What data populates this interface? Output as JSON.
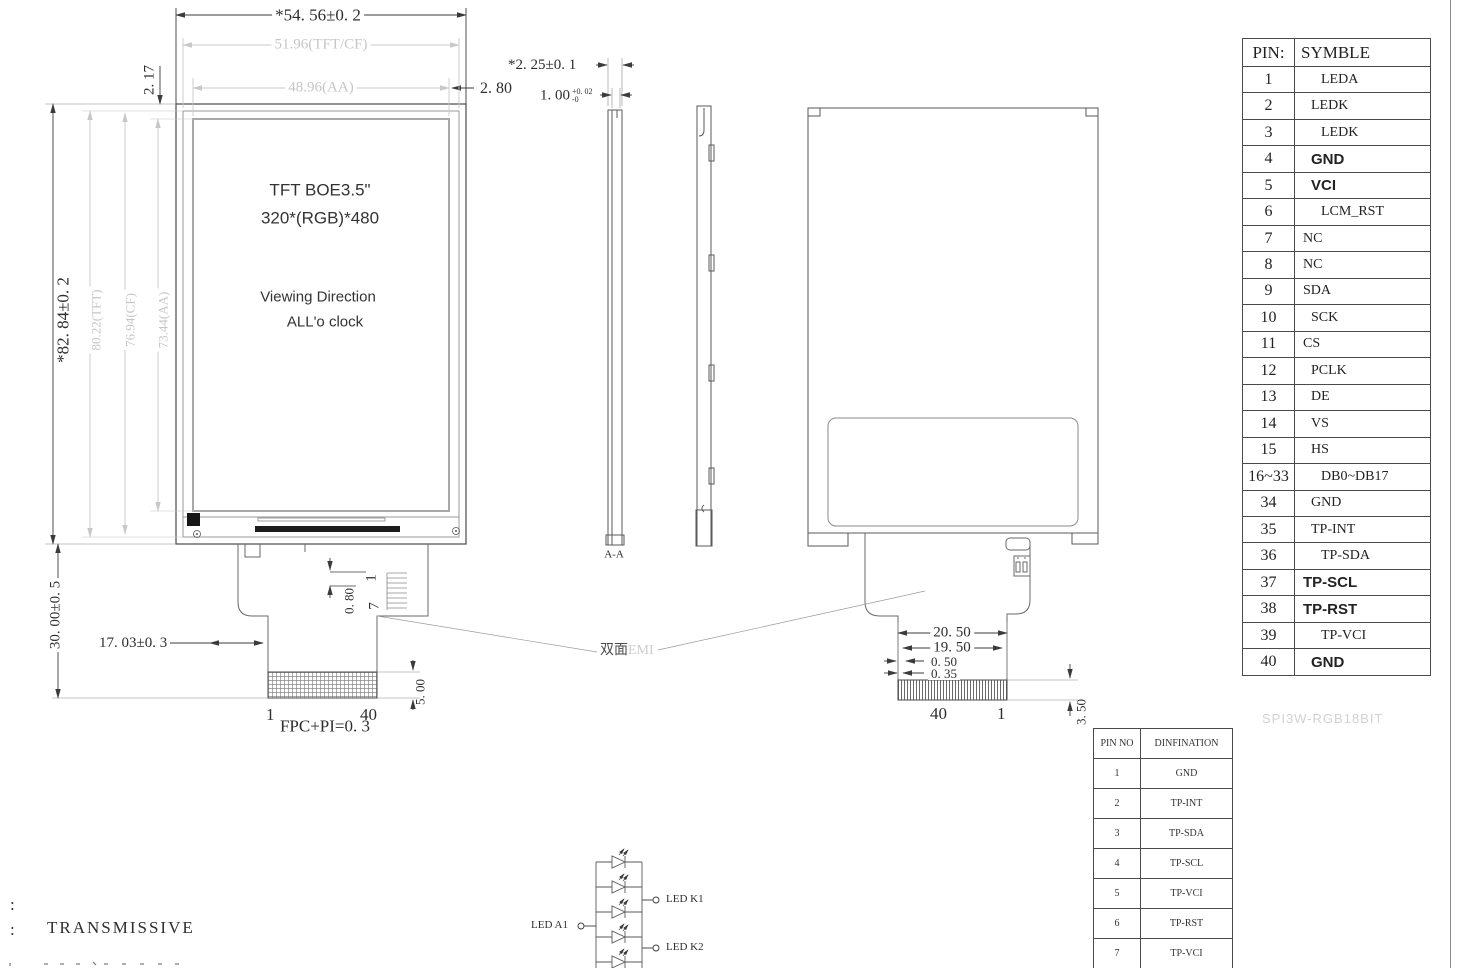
{
  "front_view": {
    "display_title": "TFT BOE3.5\"",
    "display_resolution": "320*(RGB)*480",
    "viewing_line1": "Viewing Direction",
    "viewing_line2": "ALL'o clock",
    "dims": {
      "width_total": "*54. 56±0. 2",
      "width_tft": "51.96(TFT/CF)",
      "width_aa": "48.96(AA)",
      "offset_right": "2. 80",
      "offset_top": "2. 17",
      "height_total": "*82. 84±0. 2",
      "height_tft": "80.22(TFT)",
      "height_cf": "76.94(CF)",
      "height_aa": "73.44(AA)",
      "fpc_length": "30. 00±0. 5",
      "fpc_offset": "17. 03±0. 3",
      "bl_pin_pitch": "0. 80",
      "bl_pin_first": "1",
      "bl_pin_last": "7",
      "conn_pin_first": "1",
      "conn_pin_last": "40",
      "conn_depth": "5. 00",
      "fpc_note": "FPC+PI=0. 3"
    }
  },
  "section_view": {
    "label": "A-A",
    "thickness_total": "*2. 25±0. 1",
    "thickness_value": "1. 00",
    "tol_plus": "+0. 02",
    "tol_minus": "-0"
  },
  "back_view": {
    "emi_dark": "双面",
    "emi_light": "EMI",
    "dims": {
      "w1": "20. 50",
      "w2": "19. 50",
      "w3": "0. 50",
      "w4": "0. 35",
      "pin_left": "40",
      "pin_right": "1",
      "depth": "3. 50"
    }
  },
  "pin_table": {
    "header": {
      "col1": "PIN:",
      "col2": "SYMBLE"
    },
    "rows": [
      {
        "pin": "1",
        "symbol": "LEDA",
        "cls": "in2"
      },
      {
        "pin": "2",
        "symbol": "LEDK",
        "cls": "in1"
      },
      {
        "pin": "3",
        "symbol": "LEDK",
        "cls": "in2"
      },
      {
        "pin": "4",
        "symbol": "GND",
        "cls": "bold in1"
      },
      {
        "pin": "5",
        "symbol": "VCI",
        "cls": "bold in1"
      },
      {
        "pin": "6",
        "symbol": "LCM_RST",
        "cls": "in2"
      },
      {
        "pin": "7",
        "symbol": "NC",
        "cls": ""
      },
      {
        "pin": "8",
        "symbol": "NC",
        "cls": ""
      },
      {
        "pin": "9",
        "symbol": "SDA",
        "cls": ""
      },
      {
        "pin": "10",
        "symbol": "SCK",
        "cls": "in1"
      },
      {
        "pin": "11",
        "symbol": "CS",
        "cls": ""
      },
      {
        "pin": "12",
        "symbol": "PCLK",
        "cls": "in1"
      },
      {
        "pin": "13",
        "symbol": "DE",
        "cls": "in1"
      },
      {
        "pin": "14",
        "symbol": "VS",
        "cls": "in1"
      },
      {
        "pin": "15",
        "symbol": "HS",
        "cls": "in1"
      },
      {
        "pin": "16~33",
        "symbol": "DB0~DB17",
        "cls": "in2"
      },
      {
        "pin": "34",
        "symbol": "GND",
        "cls": "in1"
      },
      {
        "pin": "35",
        "symbol": "TP-INT",
        "cls": "in1"
      },
      {
        "pin": "36",
        "symbol": "TP-SDA",
        "cls": "in2"
      },
      {
        "pin": "37",
        "symbol": "TP-SCL",
        "cls": "bold"
      },
      {
        "pin": "38",
        "symbol": "TP-RST",
        "cls": "bold"
      },
      {
        "pin": "39",
        "symbol": "TP-VCI",
        "cls": "in2"
      },
      {
        "pin": "40",
        "symbol": "GND",
        "cls": "bold in1"
      }
    ]
  },
  "tp_table": {
    "header": {
      "col1": "PIN NO",
      "col2": "DINFINATION"
    },
    "rows": [
      {
        "pin": "1",
        "symbol": "GND"
      },
      {
        "pin": "2",
        "symbol": "TP-INT"
      },
      {
        "pin": "3",
        "symbol": "TP-SDA"
      },
      {
        "pin": "4",
        "symbol": "TP-SCL"
      },
      {
        "pin": "5",
        "symbol": "TP-VCI"
      },
      {
        "pin": "6",
        "symbol": "TP-RST"
      },
      {
        "pin": "7",
        "symbol": "TP-VCI"
      }
    ]
  },
  "interface_label": "SPI3W-RGB18BIT",
  "led_circuit": {
    "anode_label": "LED A1",
    "cathode1_label": "LED K1",
    "cathode2_label": "LED K2"
  },
  "notes": {
    "line1_prefix": ":",
    "line2_prefix": ":",
    "line2_text": "TRANSMISSIVE"
  },
  "colors": {
    "line": "#3b3b3b",
    "gray_dim": "#c8c8c8",
    "ic_bar": "#1c1c1c"
  }
}
